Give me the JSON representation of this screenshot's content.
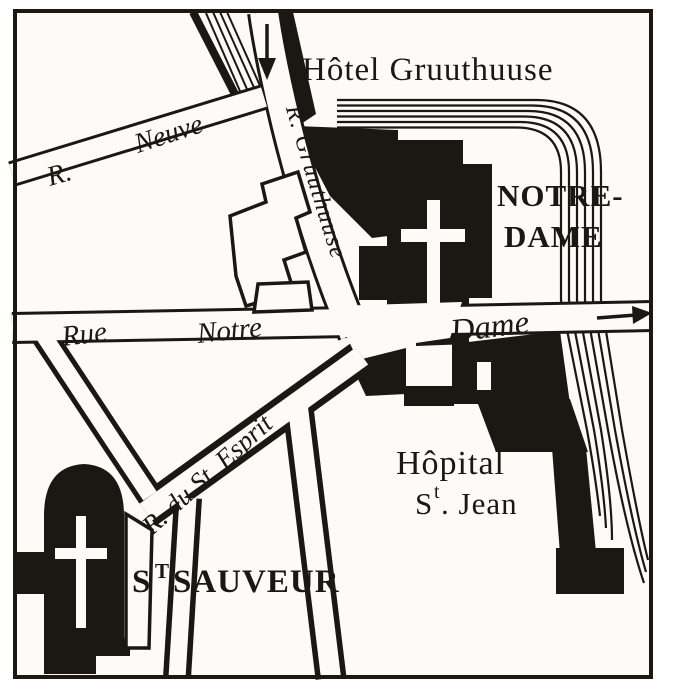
{
  "colors": {
    "ink": "#1b1713",
    "paper": "#fcfbf7",
    "page": "#ffffff"
  },
  "labels": {
    "hotel_gruuthuuse": "Hôtel Gruuthuuse",
    "notre_dame": {
      "line1": "NOTRE-",
      "line2": "DAME"
    },
    "hopital": {
      "line1": "Hôpital",
      "s": "S",
      "sup": "t",
      "rest": ". Jean"
    },
    "st_sauveur": {
      "s": "S",
      "sup": "T",
      "rest": "SAUVEUR"
    },
    "streets": {
      "r_abbrev": "R.",
      "neuve": "Neuve",
      "gruuthuuse": "R. Gruuthuuse",
      "rue": "Rue",
      "notre": "Notre",
      "dame": "Dame",
      "esprit": "R. du St. Esprit"
    }
  },
  "icons": {
    "down_arrow": "↓",
    "right_arrow": "→",
    "church_cross": "✝"
  }
}
